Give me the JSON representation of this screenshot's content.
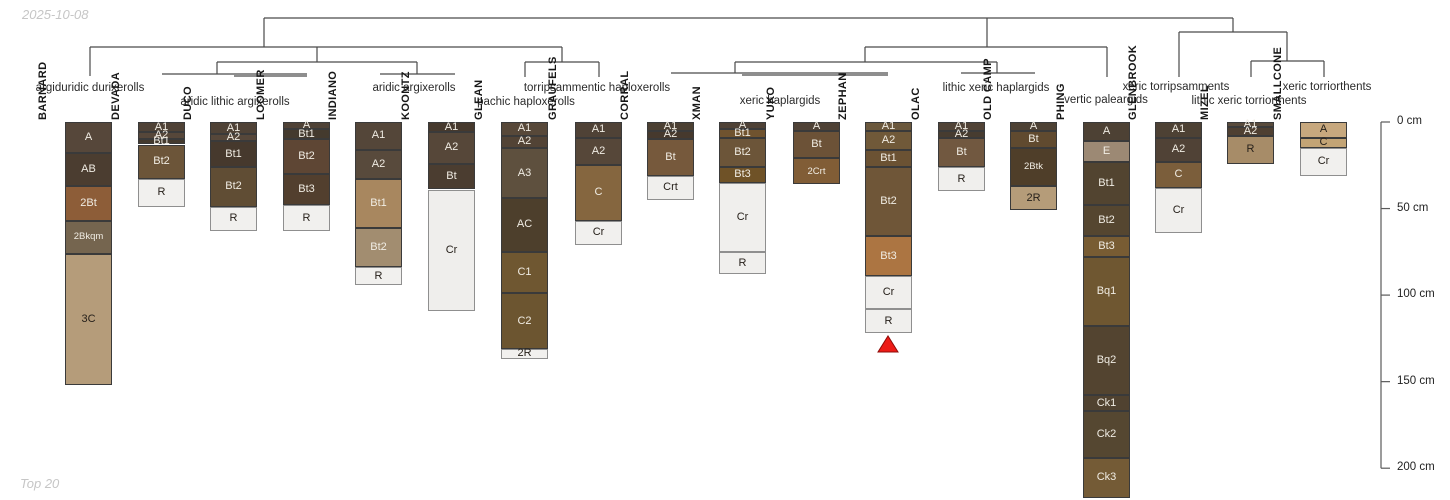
{
  "chart_data": {
    "type": "dendrogram-soil-profiles",
    "title": "Soil series profile sketches grouped by subgroup taxonomy (hierarchical clustering)",
    "date": "2025-10-08",
    "footer": "Top 20",
    "depth_axis": {
      "unit": "cm",
      "ticks": [
        0,
        50,
        100,
        150,
        200
      ],
      "tick_labels": [
        "0 cm",
        "50 cm",
        "100 cm",
        "150 cm",
        "200 cm"
      ],
      "axis_x": 1381,
      "top_px": 122,
      "px_per_cm": 1.731
    },
    "dendrogram": {
      "line_color": "#4a4a4a",
      "segments": [
        [
          264,
          18,
          1233,
          18
        ],
        [
          264,
          18,
          264,
          47
        ],
        [
          987,
          18,
          987,
          47
        ],
        [
          1233,
          18,
          1233,
          32
        ],
        [
          90,
          47,
          562,
          47
        ],
        [
          90,
          47,
          90,
          76
        ],
        [
          317,
          47,
          317,
          62
        ],
        [
          217,
          62,
          417,
          62
        ],
        [
          217,
          62,
          217,
          74
        ],
        [
          162,
          74,
          307,
          74
        ],
        [
          234,
          76,
          307,
          76
        ],
        [
          417,
          62,
          417,
          74
        ],
        [
          380,
          74,
          455,
          74
        ],
        [
          562,
          47,
          562,
          62
        ],
        [
          525,
          62,
          599,
          62
        ],
        [
          525,
          62,
          525,
          77
        ],
        [
          599,
          62,
          599,
          77
        ],
        [
          865,
          47,
          1107,
          47
        ],
        [
          865,
          47,
          865,
          62
        ],
        [
          735,
          62,
          997,
          62
        ],
        [
          735,
          62,
          735,
          73
        ],
        [
          671,
          73,
          888,
          73
        ],
        [
          742,
          75,
          888,
          75
        ],
        [
          997,
          62,
          997,
          73
        ],
        [
          961,
          73,
          1035,
          73
        ],
        [
          1107,
          47,
          1107,
          77
        ],
        [
          1179,
          32,
          1287,
          32
        ],
        [
          1179,
          32,
          1179,
          77
        ],
        [
          1287,
          32,
          1287,
          61
        ],
        [
          1251,
          61,
          1324,
          61
        ],
        [
          1251,
          61,
          1251,
          77
        ],
        [
          1324,
          61,
          1324,
          77
        ]
      ]
    },
    "groups": [
      {
        "label": "argiduridic durixerolls",
        "x": 90,
        "y": 82,
        "series": [
          "BARNARD"
        ]
      },
      {
        "label": "aridic lithic argixerolls",
        "x": 235,
        "y": 96,
        "series": [
          "DEVADA",
          "DUCO",
          "LOOMER"
        ]
      },
      {
        "label": "aridic argixerolls",
        "x": 414,
        "y": 82,
        "series": [
          "INDIANO",
          "KOONTZ"
        ]
      },
      {
        "label": "pachic haploxerolls",
        "x": 526,
        "y": 96,
        "series": [
          "GLEAN"
        ]
      },
      {
        "label": "torripsammentic haploxerolls",
        "x": 597,
        "y": 82,
        "series": [
          "GRAUFELS"
        ]
      },
      {
        "label": "xeric haplargids",
        "x": 780,
        "y": 95,
        "series": [
          "CORRAL",
          "XMAN",
          "YUKO",
          "ZEPHAN"
        ]
      },
      {
        "label": "lithic xeric haplargids",
        "x": 996,
        "y": 82,
        "series": [
          "OLAC",
          "OLD CAMP"
        ]
      },
      {
        "label": "vertic paleargids",
        "x": 1106,
        "y": 94,
        "series": [
          "PHING"
        ]
      },
      {
        "label": "xeric torripsamments",
        "x": 1176,
        "y": 81,
        "series": [
          "GLENBROOK"
        ]
      },
      {
        "label": "lithic xeric torriorthents",
        "x": 1249,
        "y": 95,
        "series": [
          "MIZEL"
        ]
      },
      {
        "label": "xeric torriorthents",
        "x": 1327,
        "y": 81,
        "series": [
          "SMALLCONE"
        ]
      }
    ],
    "marker": {
      "series": "ZEPHAN",
      "symbol": "red-triangle",
      "x": 888,
      "y_top": 336,
      "y_base": 352,
      "half_width": 10,
      "fill": "#ed1b16",
      "stroke": "#8f0b08"
    },
    "column_width": 47,
    "profiles": [
      {
        "name": "BARNARD",
        "x": 65,
        "horizons": [
          {
            "label": "A",
            "top_cm": 0,
            "bottom_cm": 18,
            "color": "#56473a"
          },
          {
            "label": "AB",
            "top_cm": 18,
            "bottom_cm": 37,
            "color": "#4b3d30"
          },
          {
            "label": "2Bt",
            "top_cm": 37,
            "bottom_cm": 57,
            "color": "#8d5d38"
          },
          {
            "label": "2Bkqm",
            "top_cm": 57,
            "bottom_cm": 76,
            "color": "#75654f"
          },
          {
            "label": "3C",
            "top_cm": 76,
            "bottom_cm": 152,
            "color": "#b59c7a",
            "text": "dark"
          }
        ]
      },
      {
        "name": "DEVADA",
        "x": 138,
        "horizons": [
          {
            "label": "A1",
            "top_cm": 0,
            "bottom_cm": 6,
            "color": "#4f4236"
          },
          {
            "label": "A2",
            "top_cm": 6,
            "bottom_cm": 10,
            "color": "#56473a"
          },
          {
            "label": "Bt1",
            "top_cm": 10,
            "bottom_cm": 13,
            "color": "#443a2e"
          },
          {
            "label": "Bt2",
            "top_cm": 13,
            "bottom_cm": 33,
            "color": "#6c5539"
          },
          {
            "label": "R",
            "top_cm": 33,
            "bottom_cm": 49,
            "color": "#f1f0ee",
            "text": "dark"
          }
        ]
      },
      {
        "name": "DUCO",
        "x": 210,
        "horizons": [
          {
            "label": "A1",
            "top_cm": 0,
            "bottom_cm": 7,
            "color": "#4f4236"
          },
          {
            "label": "A2",
            "top_cm": 7,
            "bottom_cm": 11,
            "color": "#56473a"
          },
          {
            "label": "Bt1",
            "top_cm": 11,
            "bottom_cm": 26,
            "color": "#46392d"
          },
          {
            "label": "Bt2",
            "top_cm": 26,
            "bottom_cm": 49,
            "color": "#604d34"
          },
          {
            "label": "R",
            "top_cm": 49,
            "bottom_cm": 63,
            "color": "#f1f0ee",
            "text": "dark"
          }
        ]
      },
      {
        "name": "LOOMER",
        "x": 283,
        "horizons": [
          {
            "label": "A",
            "top_cm": 0,
            "bottom_cm": 4,
            "color": "#4f4236"
          },
          {
            "label": "Bt1",
            "top_cm": 4,
            "bottom_cm": 10,
            "color": "#443a2e"
          },
          {
            "label": "Bt2",
            "top_cm": 10,
            "bottom_cm": 30,
            "color": "#5e4634"
          },
          {
            "label": "Bt3",
            "top_cm": 30,
            "bottom_cm": 48,
            "color": "#523f2e"
          },
          {
            "label": "R",
            "top_cm": 48,
            "bottom_cm": 63,
            "color": "#f1f0ee",
            "text": "dark"
          }
        ]
      },
      {
        "name": "INDIANO",
        "x": 355,
        "horizons": [
          {
            "label": "A1",
            "top_cm": 0,
            "bottom_cm": 16,
            "color": "#544639"
          },
          {
            "label": "A2",
            "top_cm": 16,
            "bottom_cm": 33,
            "color": "#584a3c"
          },
          {
            "label": "Bt1",
            "top_cm": 33,
            "bottom_cm": 61,
            "color": "#a8875f"
          },
          {
            "label": "Bt2",
            "top_cm": 61,
            "bottom_cm": 84,
            "color": "#a28d70"
          },
          {
            "label": "R",
            "top_cm": 84,
            "bottom_cm": 94,
            "color": "#f1f0ee",
            "text": "dark"
          }
        ]
      },
      {
        "name": "KOONTZ",
        "x": 428,
        "horizons": [
          {
            "label": "A1",
            "top_cm": 0,
            "bottom_cm": 6,
            "color": "#46392d"
          },
          {
            "label": "A2",
            "top_cm": 6,
            "bottom_cm": 24,
            "color": "#564739"
          },
          {
            "label": "Bt",
            "top_cm": 24,
            "bottom_cm": 39,
            "color": "#4b3d30"
          },
          {
            "label": "Cr",
            "top_cm": 39,
            "bottom_cm": 109,
            "color": "#efeeec",
            "text": "dark"
          }
        ]
      },
      {
        "name": "GLEAN",
        "x": 501,
        "horizons": [
          {
            "label": "A1",
            "top_cm": 0,
            "bottom_cm": 8,
            "color": "#574839"
          },
          {
            "label": "A2",
            "top_cm": 8,
            "bottom_cm": 15,
            "color": "#524335"
          },
          {
            "label": "A3",
            "top_cm": 15,
            "bottom_cm": 44,
            "color": "#5e503e"
          },
          {
            "label": "AC",
            "top_cm": 44,
            "bottom_cm": 75,
            "color": "#4d3f2c"
          },
          {
            "label": "C1",
            "top_cm": 75,
            "bottom_cm": 99,
            "color": "#6f5731"
          },
          {
            "label": "C2",
            "top_cm": 99,
            "bottom_cm": 131,
            "color": "#6c5530"
          },
          {
            "label": "2R",
            "top_cm": 131,
            "bottom_cm": 137,
            "color": "#f1f0ee",
            "text": "dark"
          }
        ]
      },
      {
        "name": "GRAUFELS",
        "x": 575,
        "horizons": [
          {
            "label": "A1",
            "top_cm": 0,
            "bottom_cm": 9,
            "color": "#4f4236"
          },
          {
            "label": "A2",
            "top_cm": 9,
            "bottom_cm": 25,
            "color": "#564739"
          },
          {
            "label": "C",
            "top_cm": 25,
            "bottom_cm": 57,
            "color": "#85663f"
          },
          {
            "label": "Cr",
            "top_cm": 57,
            "bottom_cm": 71,
            "color": "#f1f0ee",
            "text": "dark"
          }
        ]
      },
      {
        "name": "CORRAL",
        "x": 647,
        "horizons": [
          {
            "label": "A1",
            "top_cm": 0,
            "bottom_cm": 5,
            "color": "#4c4033"
          },
          {
            "label": "A2",
            "top_cm": 5,
            "bottom_cm": 10,
            "color": "#46392d"
          },
          {
            "label": "Bt",
            "top_cm": 10,
            "bottom_cm": 31,
            "color": "#76593c"
          },
          {
            "label": "Crt",
            "top_cm": 31,
            "bottom_cm": 45,
            "color": "#f0efed",
            "text": "dark"
          }
        ]
      },
      {
        "name": "XMAN",
        "x": 719,
        "horizons": [
          {
            "label": "A",
            "top_cm": 0,
            "bottom_cm": 4,
            "color": "#4f4236"
          },
          {
            "label": "Bt1",
            "top_cm": 4,
            "bottom_cm": 9,
            "color": "#70532f"
          },
          {
            "label": "Bt2",
            "top_cm": 9,
            "bottom_cm": 26,
            "color": "#6c5539"
          },
          {
            "label": "Bt3",
            "top_cm": 26,
            "bottom_cm": 35,
            "color": "#6f5227"
          },
          {
            "label": "Cr",
            "top_cm": 35,
            "bottom_cm": 75,
            "color": "#f0efed",
            "text": "dark"
          },
          {
            "label": "R",
            "top_cm": 75,
            "bottom_cm": 88,
            "color": "#f0efed",
            "text": "dark"
          }
        ]
      },
      {
        "name": "YUKO",
        "x": 793,
        "horizons": [
          {
            "label": "A",
            "top_cm": 0,
            "bottom_cm": 5,
            "color": "#4f4236"
          },
          {
            "label": "Bt",
            "top_cm": 5,
            "bottom_cm": 21,
            "color": "#6c5237"
          },
          {
            "label": "2Crt",
            "top_cm": 21,
            "bottom_cm": 36,
            "color": "#815d36"
          }
        ]
      },
      {
        "name": "ZEPHAN",
        "x": 865,
        "horizons": [
          {
            "label": "A1",
            "top_cm": 0,
            "bottom_cm": 5,
            "color": "#6b583d"
          },
          {
            "label": "A2",
            "top_cm": 5,
            "bottom_cm": 16,
            "color": "#705939"
          },
          {
            "label": "Bt1",
            "top_cm": 16,
            "bottom_cm": 26,
            "color": "#6b5233"
          },
          {
            "label": "Bt2",
            "top_cm": 26,
            "bottom_cm": 66,
            "color": "#6f5638"
          },
          {
            "label": "Bt3",
            "top_cm": 66,
            "bottom_cm": 89,
            "color": "#ac7542"
          },
          {
            "label": "Cr",
            "top_cm": 89,
            "bottom_cm": 108,
            "color": "#f0efed",
            "text": "dark"
          },
          {
            "label": "R",
            "top_cm": 108,
            "bottom_cm": 122,
            "color": "#f0efed",
            "text": "dark"
          }
        ]
      },
      {
        "name": "OLAC",
        "x": 938,
        "horizons": [
          {
            "label": "A1",
            "top_cm": 0,
            "bottom_cm": 5,
            "color": "#514336"
          },
          {
            "label": "A2",
            "top_cm": 5,
            "bottom_cm": 9,
            "color": "#473c30"
          },
          {
            "label": "Bt",
            "top_cm": 9,
            "bottom_cm": 26,
            "color": "#715840"
          },
          {
            "label": "R",
            "top_cm": 26,
            "bottom_cm": 40,
            "color": "#f0efed",
            "text": "dark"
          }
        ]
      },
      {
        "name": "OLD CAMP",
        "x": 1010,
        "horizons": [
          {
            "label": "A",
            "top_cm": 0,
            "bottom_cm": 5,
            "color": "#4d4134"
          },
          {
            "label": "Bt",
            "top_cm": 5,
            "bottom_cm": 15,
            "color": "#604a2f"
          },
          {
            "label": "2Btk",
            "top_cm": 15,
            "bottom_cm": 37,
            "color": "#4f3e29"
          },
          {
            "label": "2R",
            "top_cm": 37,
            "bottom_cm": 51,
            "color": "#b59c79",
            "text": "dark"
          }
        ]
      },
      {
        "name": "PHING",
        "x": 1083,
        "horizons": [
          {
            "label": "A",
            "top_cm": 0,
            "bottom_cm": 11,
            "color": "#4d4134"
          },
          {
            "label": "E",
            "top_cm": 11,
            "bottom_cm": 23,
            "color": "#9c8974"
          },
          {
            "label": "Bt1",
            "top_cm": 23,
            "bottom_cm": 48,
            "color": "#524430"
          },
          {
            "label": "Bt2",
            "top_cm": 48,
            "bottom_cm": 66,
            "color": "#554630"
          },
          {
            "label": "Bt3",
            "top_cm": 66,
            "bottom_cm": 78,
            "color": "#785c33"
          },
          {
            "label": "Bq1",
            "top_cm": 78,
            "bottom_cm": 118,
            "color": "#6f5731"
          },
          {
            "label": "Bq2",
            "top_cm": 118,
            "bottom_cm": 158,
            "color": "#534430"
          },
          {
            "label": "Ck1",
            "top_cm": 158,
            "bottom_cm": 167,
            "color": "#504230"
          },
          {
            "label": "Ck2",
            "top_cm": 167,
            "bottom_cm": 194,
            "color": "#554731"
          },
          {
            "label": "Ck3",
            "top_cm": 194,
            "bottom_cm": 217,
            "color": "#745b36"
          }
        ]
      },
      {
        "name": "GLENBROOK",
        "x": 1155,
        "horizons": [
          {
            "label": "A1",
            "top_cm": 0,
            "bottom_cm": 9,
            "color": "#4d4134"
          },
          {
            "label": "A2",
            "top_cm": 9,
            "bottom_cm": 23,
            "color": "#504236"
          },
          {
            "label": "C",
            "top_cm": 23,
            "bottom_cm": 38,
            "color": "#7b5e3b"
          },
          {
            "label": "Cr",
            "top_cm": 38,
            "bottom_cm": 64,
            "color": "#f0efed",
            "text": "dark"
          }
        ]
      },
      {
        "name": "MIZEL",
        "x": 1227,
        "horizons": [
          {
            "label": "A1",
            "top_cm": 0,
            "bottom_cm": 3,
            "color": "#594b3c"
          },
          {
            "label": "A2",
            "top_cm": 3,
            "bottom_cm": 8,
            "color": "#4f4032"
          },
          {
            "label": "R",
            "top_cm": 8,
            "bottom_cm": 24,
            "color": "#a78c68",
            "text": "dark"
          }
        ]
      },
      {
        "name": "SMALLCONE",
        "x": 1300,
        "horizons": [
          {
            "label": "A",
            "top_cm": 0,
            "bottom_cm": 9,
            "color": "#c7a87e",
            "text": "dark"
          },
          {
            "label": "C",
            "top_cm": 9,
            "bottom_cm": 15,
            "color": "#c3a475",
            "text": "dark"
          },
          {
            "label": "Cr",
            "top_cm": 15,
            "bottom_cm": 31,
            "color": "#f1f0ee",
            "text": "dark"
          }
        ]
      }
    ]
  }
}
